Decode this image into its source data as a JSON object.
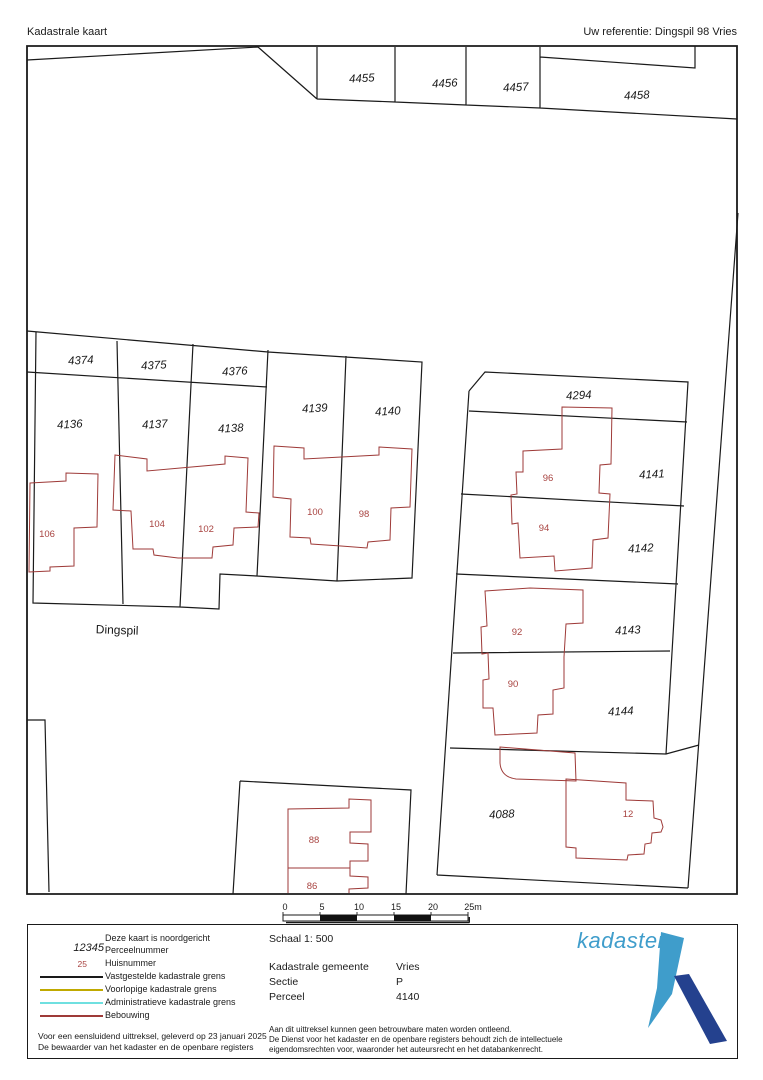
{
  "header": {
    "title": "Kadastrale kaart",
    "reference": "Uw referentie: Dingspil 98 Vries"
  },
  "map": {
    "street_label": "Dingspil",
    "parcels": [
      {
        "number": "4455"
      },
      {
        "number": "4456"
      },
      {
        "number": "4457"
      },
      {
        "number": "4458"
      },
      {
        "number": "4374"
      },
      {
        "number": "4375"
      },
      {
        "number": "4376"
      },
      {
        "number": "4136"
      },
      {
        "number": "4137"
      },
      {
        "number": "4138"
      },
      {
        "number": "4139"
      },
      {
        "number": "4140"
      },
      {
        "number": "4294"
      },
      {
        "number": "4141"
      },
      {
        "number": "4142"
      },
      {
        "number": "4143"
      },
      {
        "number": "4144"
      },
      {
        "number": "4088"
      }
    ],
    "houses": [
      {
        "number": "106"
      },
      {
        "number": "104"
      },
      {
        "number": "102"
      },
      {
        "number": "100"
      },
      {
        "number": "98"
      },
      {
        "number": "96"
      },
      {
        "number": "94"
      },
      {
        "number": "92"
      },
      {
        "number": "90"
      },
      {
        "number": "88"
      },
      {
        "number": "86"
      },
      {
        "number": "12"
      }
    ],
    "scalebar": {
      "labels": [
        "0",
        "5",
        "10",
        "15",
        "20",
        "25m"
      ]
    }
  },
  "legend": {
    "north_note": "Deze kaart is noordgericht",
    "items": [
      {
        "symbol": "12345",
        "label": "Perceelnummer"
      },
      {
        "symbol": "25",
        "label": "Huisnummer"
      },
      {
        "label": "Vastgestelde kadastrale grens",
        "color": "#1a1a1a"
      },
      {
        "label": "Voorlopige kadastrale grens",
        "color": "#c0a900"
      },
      {
        "label": "Administratieve kadastrale grens",
        "color": "#6fe0e0"
      },
      {
        "label": "Bebouwing",
        "color": "#9e3a38"
      }
    ],
    "footnote1": "Voor een eensluidend uittreksel, geleverd op 23 januari 2025",
    "footnote2": "De bewaarder van het kadaster en de openbare registers"
  },
  "details": {
    "schaal": "Schaal 1: 500",
    "fields": [
      {
        "label": "Kadastrale gemeente",
        "value": "Vries"
      },
      {
        "label": "Sectie",
        "value": "P"
      },
      {
        "label": "Perceel",
        "value": "4140"
      }
    ],
    "disclaimer": [
      "Aan dit uittreksel kunnen geen betrouwbare maten worden ontleend.",
      "De Dienst voor het kadaster en de openbare registers behoudt zich de intellectuele",
      "eigendomsrechten voor, waaronder het auteursrecht en het databankenrecht."
    ]
  },
  "logo": {
    "text": "kadaster",
    "light_color": "#3f9dcb",
    "dark_color": "#24418e"
  },
  "colors": {
    "boundary": "#1a1a1a",
    "building": "#9e3a38",
    "house_number": "#a84340"
  }
}
